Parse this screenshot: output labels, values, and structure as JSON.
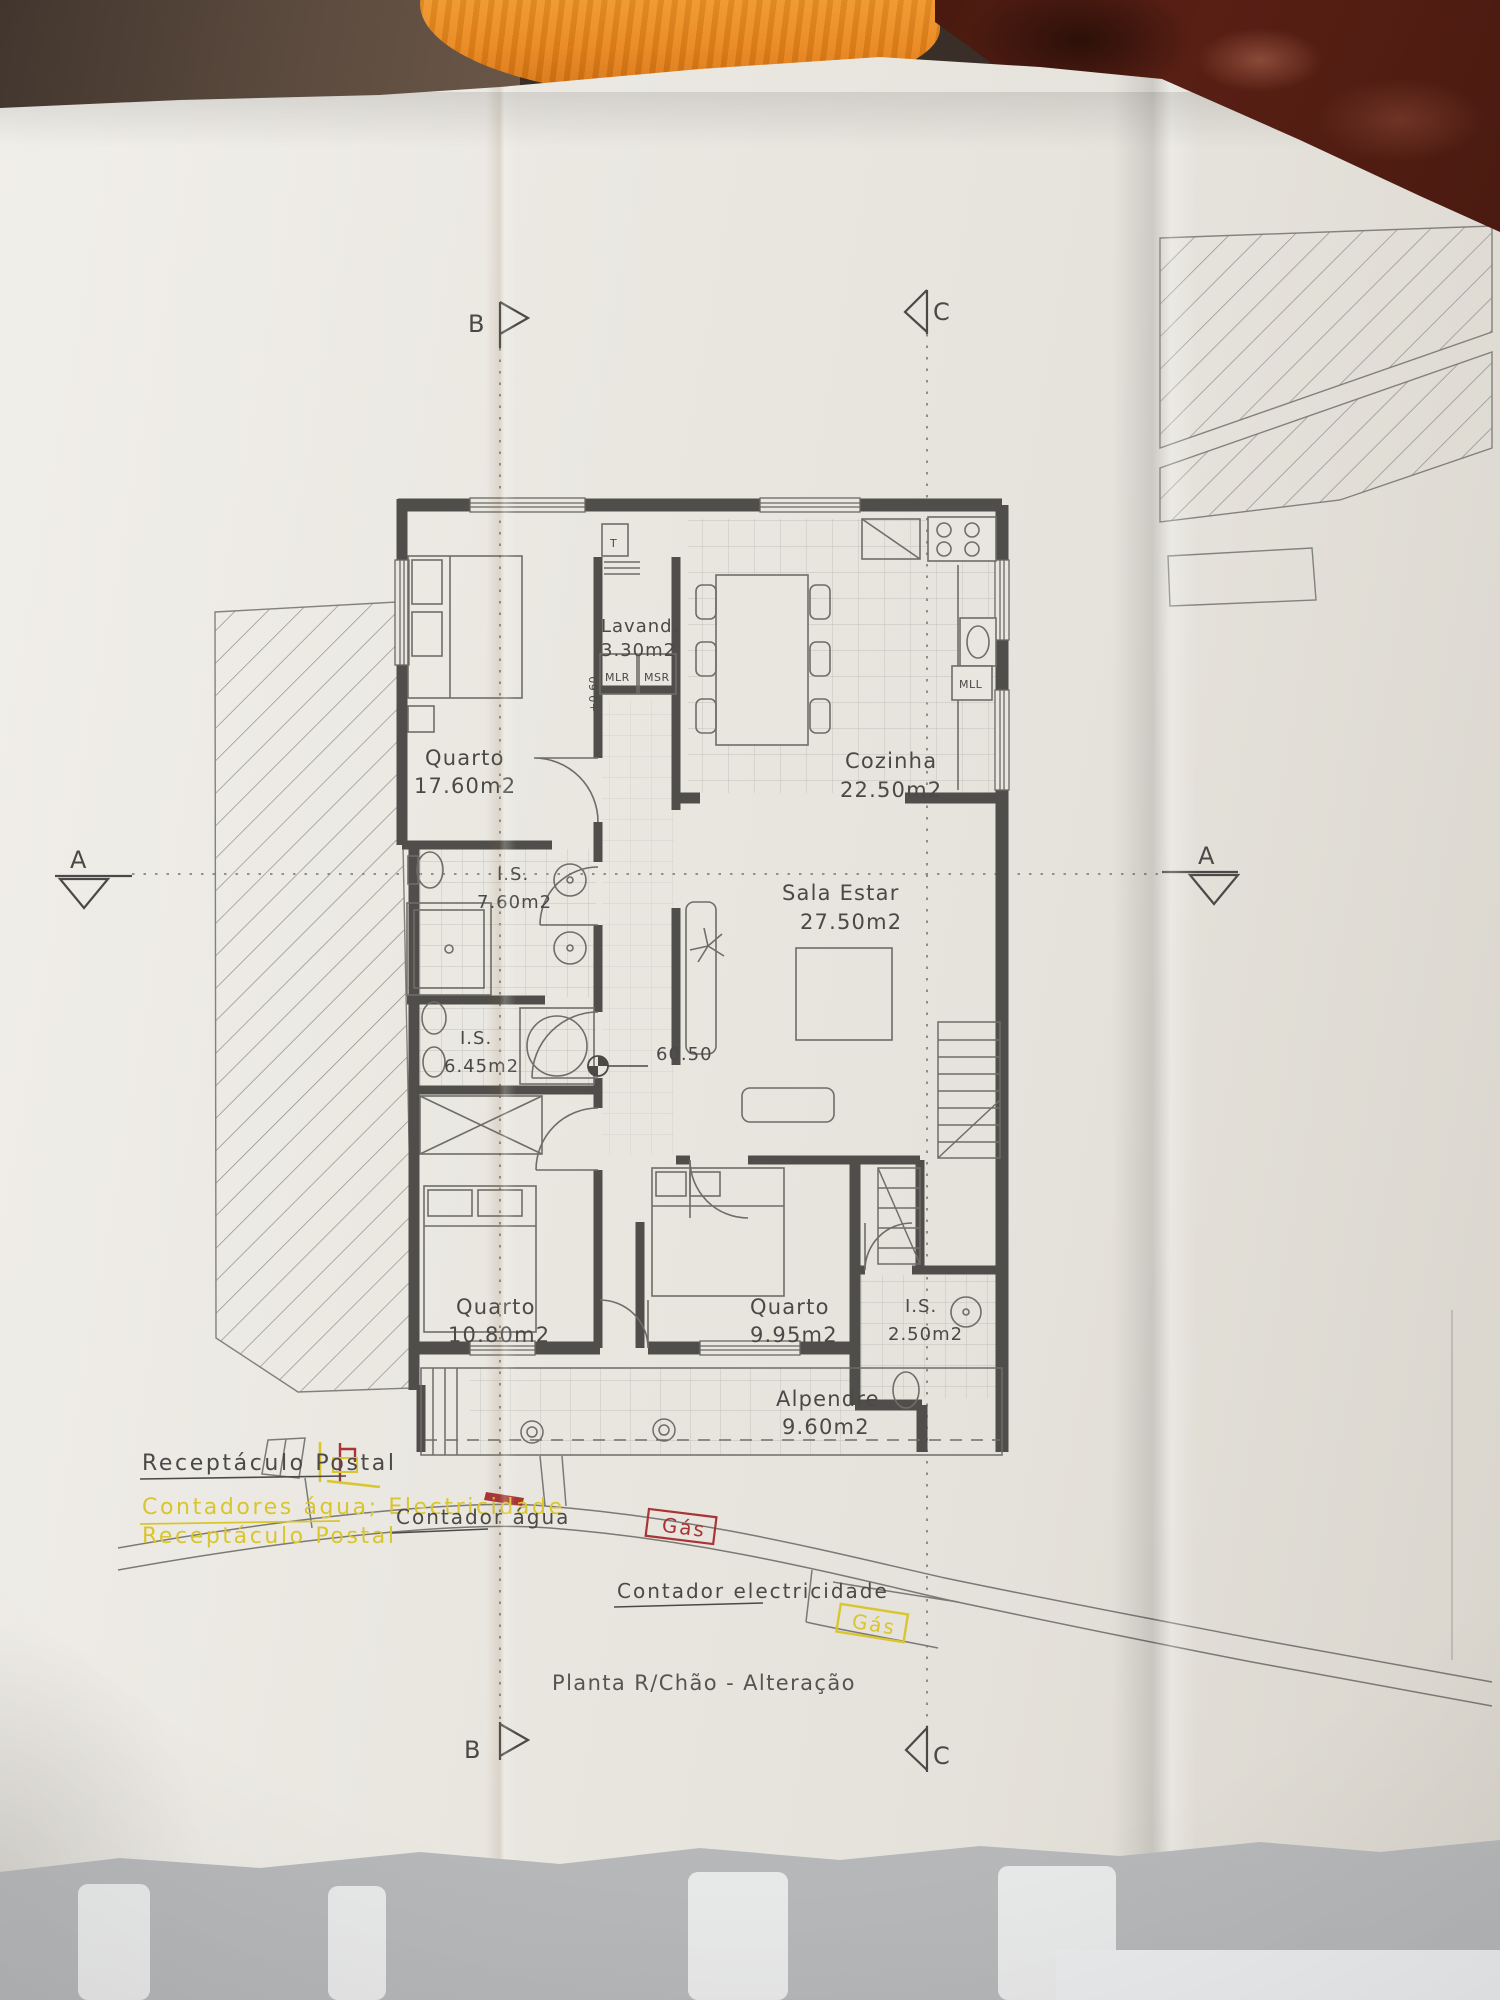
{
  "plan": {
    "title": "Planta R/Chão - Alteração",
    "rooms": [
      {
        "name": "Quarto",
        "area": "17.60m2"
      },
      {
        "name": "Lavand.",
        "area": "3.30m2"
      },
      {
        "name": "Cozinha",
        "area": "22.50m2"
      },
      {
        "name": "I.S.",
        "area": "7.60m2"
      },
      {
        "name": "Sala  Estar",
        "area": "27.50m2"
      },
      {
        "name": "I.S.",
        "area": "6.45m2"
      },
      {
        "name": "Quarto",
        "area": "10.80m2"
      },
      {
        "name": "Quarto",
        "area": "9.95m2"
      },
      {
        "name": "I.S.",
        "area": "2.50m2"
      },
      {
        "name": "Alpendre",
        "area": "9.60m2"
      }
    ],
    "appliances": {
      "washer": "MLR",
      "dryer": "MSR",
      "heater": "T",
      "dishwasher": "MLL"
    },
    "levels": {
      "floor": "60.50",
      "step": "+0.60"
    },
    "sections": {
      "a": "A",
      "b": "B",
      "c": "C"
    },
    "annotations": {
      "postal_gray": "Receptáculo Postal",
      "meters_yellow": "Contadores água; Electricidade",
      "postal_yellow": "Receptáculo Postal",
      "water_meter": "Contador água",
      "gas_red": "Gás",
      "electricity_meter": "Contador electricidade",
      "gas_yellow": "Gás"
    },
    "colors": {
      "paper": "#e9e6e0",
      "ink": "#4a4947",
      "wall": "#504e4a",
      "yellow": "#d9c52e",
      "red": "#a83434",
      "towel_orange": "#ea851b",
      "surface_maroon": "#581f14"
    }
  }
}
